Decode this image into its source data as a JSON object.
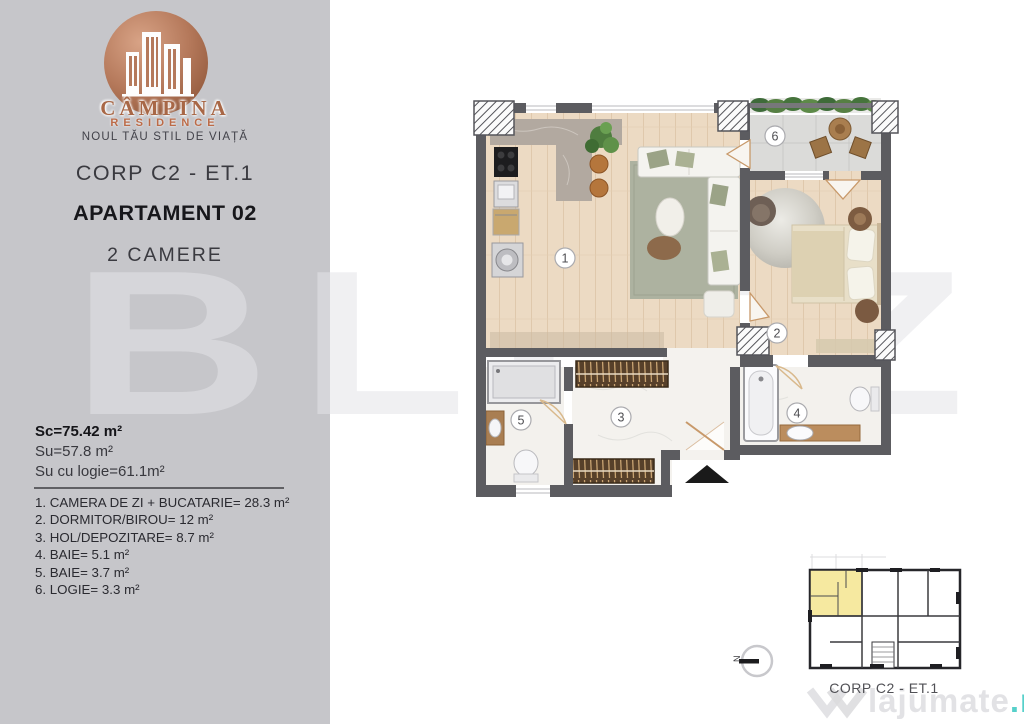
{
  "branding": {
    "name": "CÂMPINA",
    "name_sub": "RESIDENCE",
    "tagline": "NOUL TĂU STIL DE VIAȚĂ"
  },
  "header": {
    "corp": "CORP C2 - ET.1",
    "apartment": "APARTAMENT 02",
    "rooms": "2 CAMERE"
  },
  "areas": {
    "built": "Sc=75.42 m²",
    "usable": "Su=57.8 m²",
    "usable_with_loggia": "Su cu logie=61.1m²"
  },
  "room_list": [
    "1. CAMERA DE ZI + BUCATARIE= 28.3 m²",
    "2. DORMITOR/BIROU= 12 m²",
    "3. HOL/DEPOZITARE= 8.7 m²",
    "4. BAIE= 5.1 m²",
    "5. BAIE= 3.7 m²",
    "6. LOGIE= 3.3 m²"
  ],
  "floor_plan": {
    "numbers": [
      "1",
      "2",
      "3",
      "4",
      "5",
      "6"
    ]
  },
  "mini_plan": {
    "label": "CORP C2 - ET.1"
  },
  "compass": {
    "label": "N"
  },
  "watermarks": {
    "big": "BLITZ",
    "site": "lajumate",
    "site_tld": ".ro"
  },
  "colors": {
    "panel_gray": "#c6c6ca",
    "copper": "#b0735a",
    "wall_gray": "#5c5c60",
    "wood_floor": "#ecdac3",
    "highlight_yellow": "#f6e9a0",
    "teal": "#56d0ca"
  }
}
